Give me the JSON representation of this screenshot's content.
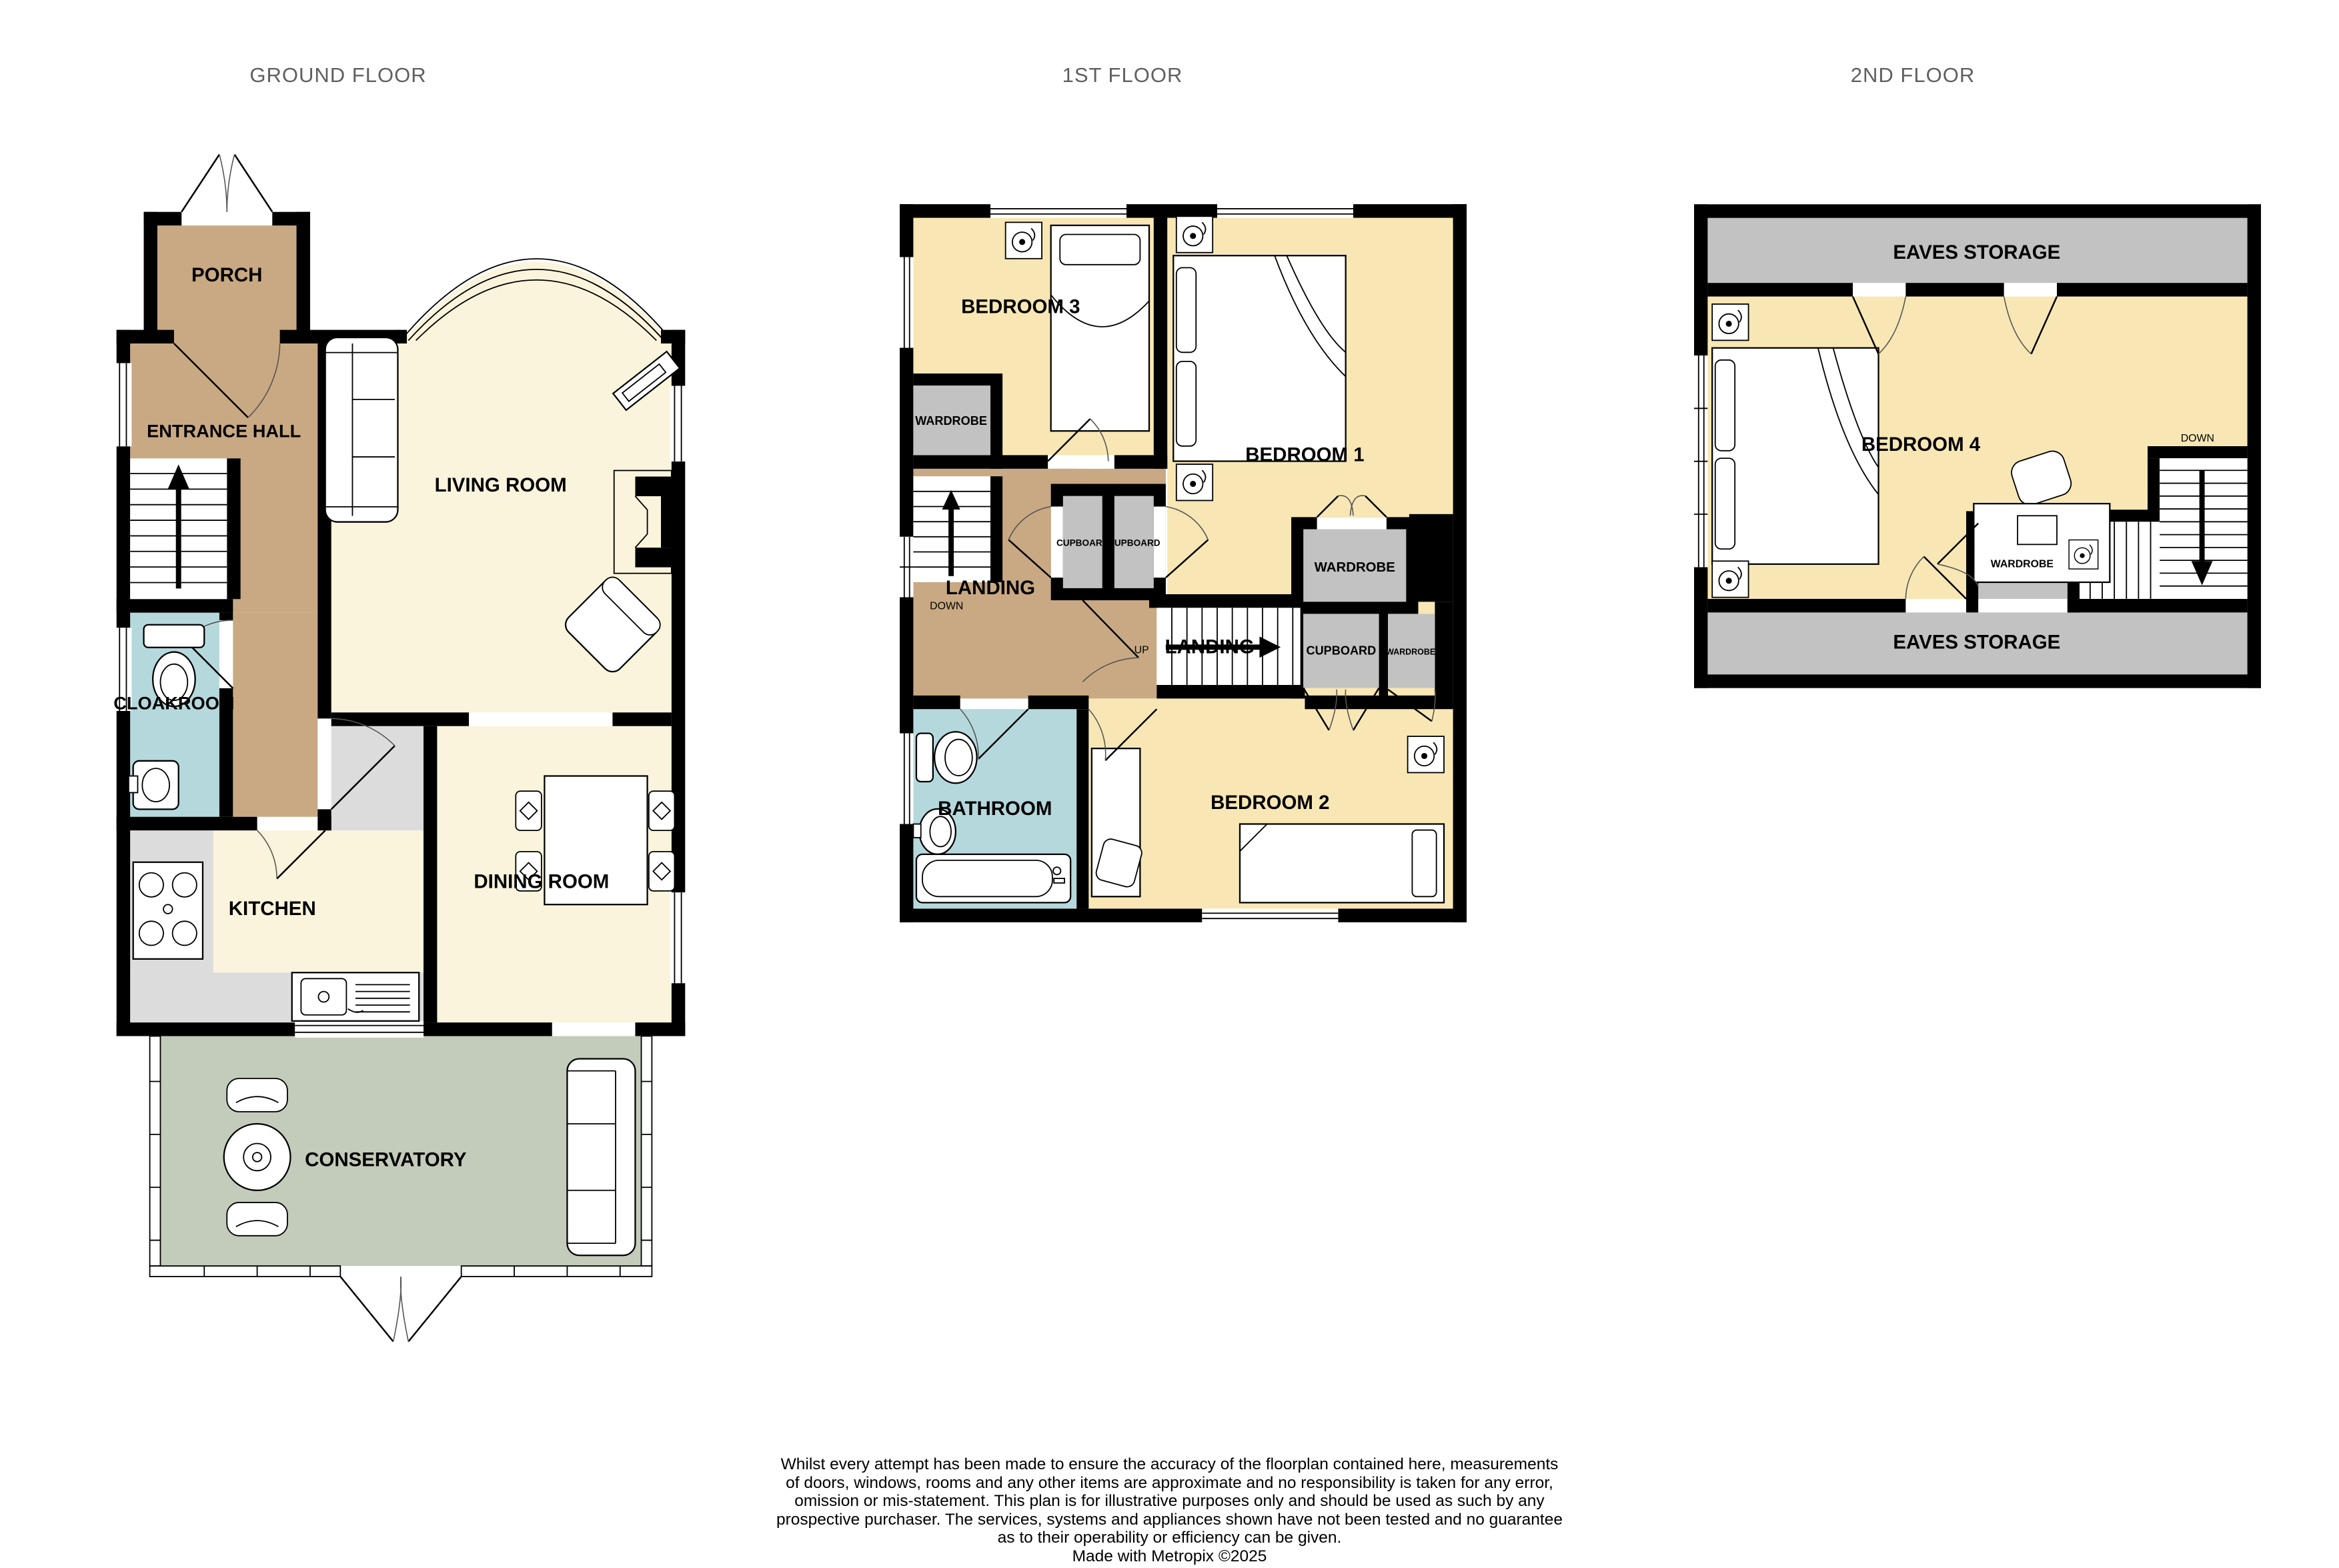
{
  "titles": {
    "ground": "GROUND FLOOR",
    "first": "1ST FLOOR",
    "second": "2ND FLOOR"
  },
  "ground_floor": {
    "rooms": {
      "porch": "PORCH",
      "entrance_hall": "ENTRANCE HALL",
      "living_room": "LIVING ROOM",
      "cloakroom": "CLOAKROOM",
      "kitchen": "KITCHEN",
      "dining_room": "DINING ROOM",
      "conservatory": "CONSERVATORY"
    }
  },
  "first_floor": {
    "rooms": {
      "bedroom3": "BEDROOM 3",
      "bedroom1": "BEDROOM 1",
      "bedroom2": "BEDROOM 2",
      "bathroom": "BATHROOM",
      "landing_main": "LANDING",
      "landing_small": "LANDING",
      "wardrobe_b3": "WARDROBE",
      "wardrobe_b1": "WARDROBE",
      "wardrobe_small": "WARDROBE",
      "cupboard_a": "CUPBOARD",
      "cupboard_b": "CUPBOARD",
      "cupboard_c": "CUPBOARD"
    },
    "annotations": {
      "down": "DOWN",
      "up": "UP"
    }
  },
  "second_floor": {
    "rooms": {
      "eaves_top": "EAVES STORAGE",
      "eaves_bottom": "EAVES STORAGE",
      "bedroom4": "BEDROOM 4",
      "wardrobe": "WARDROBE"
    },
    "annotations": {
      "down": "DOWN"
    }
  },
  "footer": {
    "lines": [
      "Whilst every attempt has been made to ensure the accuracy of the floorplan contained here, measurements",
      "of doors, windows, rooms and any other items are approximate and no responsibility is taken for any error,",
      "omission or mis-statement. This plan is for illustrative purposes only and should be used as such by any",
      "prospective purchaser. The services, systems and appliances shown have not been tested and no guarantee",
      "as to their operability or efficiency can be given."
    ],
    "credit": "Made with Metropix ©2025"
  },
  "colors": {
    "wall": "#000000",
    "room_cream": "#faf4dc",
    "room_yellow": "#f8e7b4",
    "hall_tan": "#c9a983",
    "wet_room_blue": "#b5d8dc",
    "conservatory_green": "#c3ccba",
    "storage_gray": "#c2c2c2",
    "counter_gray": "#dcdcdc",
    "title_gray": "#5f5f5f"
  }
}
